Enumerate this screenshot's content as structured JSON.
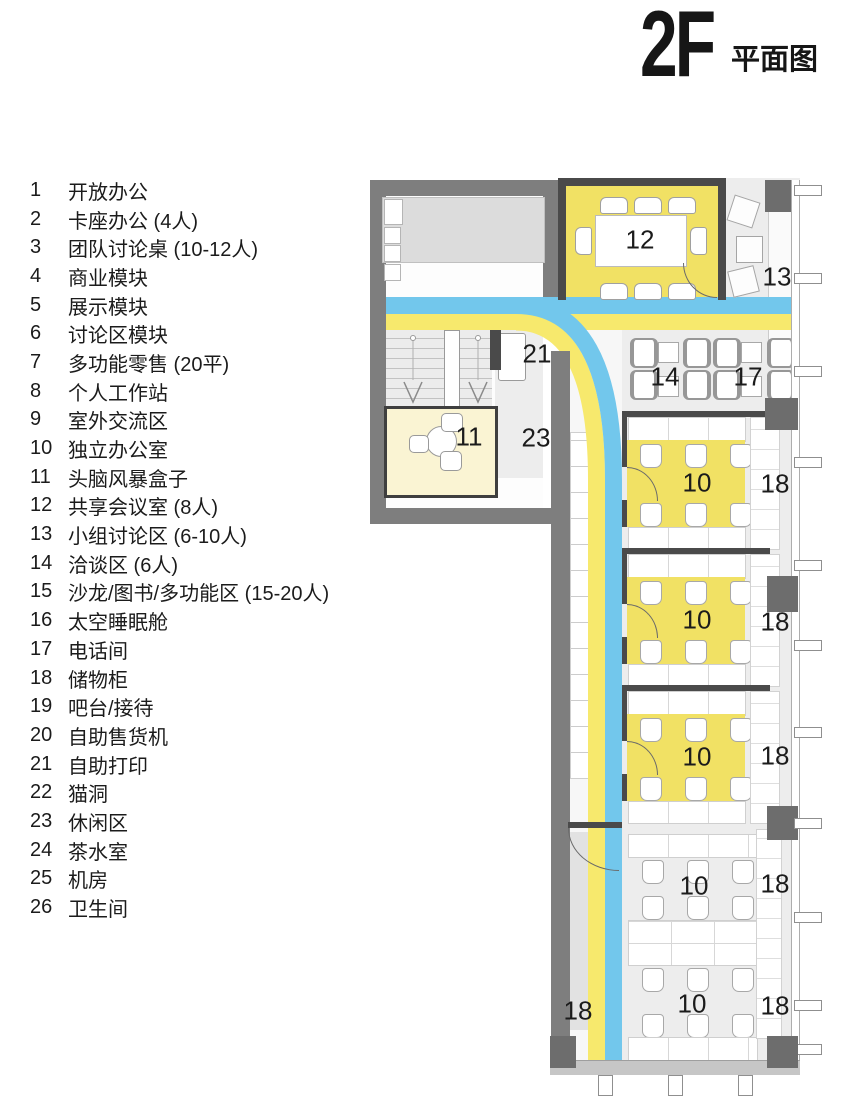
{
  "title": {
    "floor": "2F",
    "suffix": "平面图"
  },
  "legend": [
    {
      "num": "1",
      "label": "开放办公"
    },
    {
      "num": "2",
      "label": "卡座办公 (4人)"
    },
    {
      "num": "3",
      "label": "团队讨论桌 (10-12人)"
    },
    {
      "num": "4",
      "label": "商业模块"
    },
    {
      "num": "5",
      "label": "展示模块"
    },
    {
      "num": "6",
      "label": "讨论区模块"
    },
    {
      "num": "7",
      "label": "多功能零售 (20平)"
    },
    {
      "num": "8",
      "label": "个人工作站"
    },
    {
      "num": "9",
      "label": "室外交流区"
    },
    {
      "num": "10",
      "label": "独立办公室"
    },
    {
      "num": "11",
      "label": "头脑风暴盒子"
    },
    {
      "num": "12",
      "label": "共享会议室 (8人)"
    },
    {
      "num": "13",
      "label": "小组讨论区 (6-10人)"
    },
    {
      "num": "14",
      "label": "洽谈区 (6人)"
    },
    {
      "num": "15",
      "label": "沙龙/图书/多功能区 (15-20人)"
    },
    {
      "num": "16",
      "label": "太空睡眠舱"
    },
    {
      "num": "17",
      "label": "电话间"
    },
    {
      "num": "18",
      "label": "储物柜"
    },
    {
      "num": "19",
      "label": "吧台/接待"
    },
    {
      "num": "20",
      "label": "自助售货机"
    },
    {
      "num": "21",
      "label": "自助打印"
    },
    {
      "num": "22",
      "label": "猫洞"
    },
    {
      "num": "23",
      "label": "休闲区"
    },
    {
      "num": "24",
      "label": "茶水室"
    },
    {
      "num": "25",
      "label": "机房"
    },
    {
      "num": "26",
      "label": "卫生间"
    }
  ],
  "plan": {
    "labels": {
      "room12": "12",
      "room13": "13",
      "area14": "14",
      "area17": "17",
      "area21": "21",
      "area23": "23",
      "room11": "11",
      "office1": "10",
      "locker1": "18",
      "office2": "10",
      "locker2": "18",
      "office3": "10",
      "locker3": "18",
      "open1": "10",
      "locker4": "18",
      "open2": "10",
      "locker5": "18",
      "locker6": "18"
    }
  },
  "colors": {
    "band_blue": "#72c7ec",
    "band_yellow": "#f7e96d",
    "room_yellow": "#f1e164",
    "pale_yellow": "#faf4d3",
    "wall_gray": "#7e7e7e",
    "dark_wall": "#4a4a4a",
    "column_gray": "#6d6d6d",
    "bg_gray": "#ededed"
  }
}
